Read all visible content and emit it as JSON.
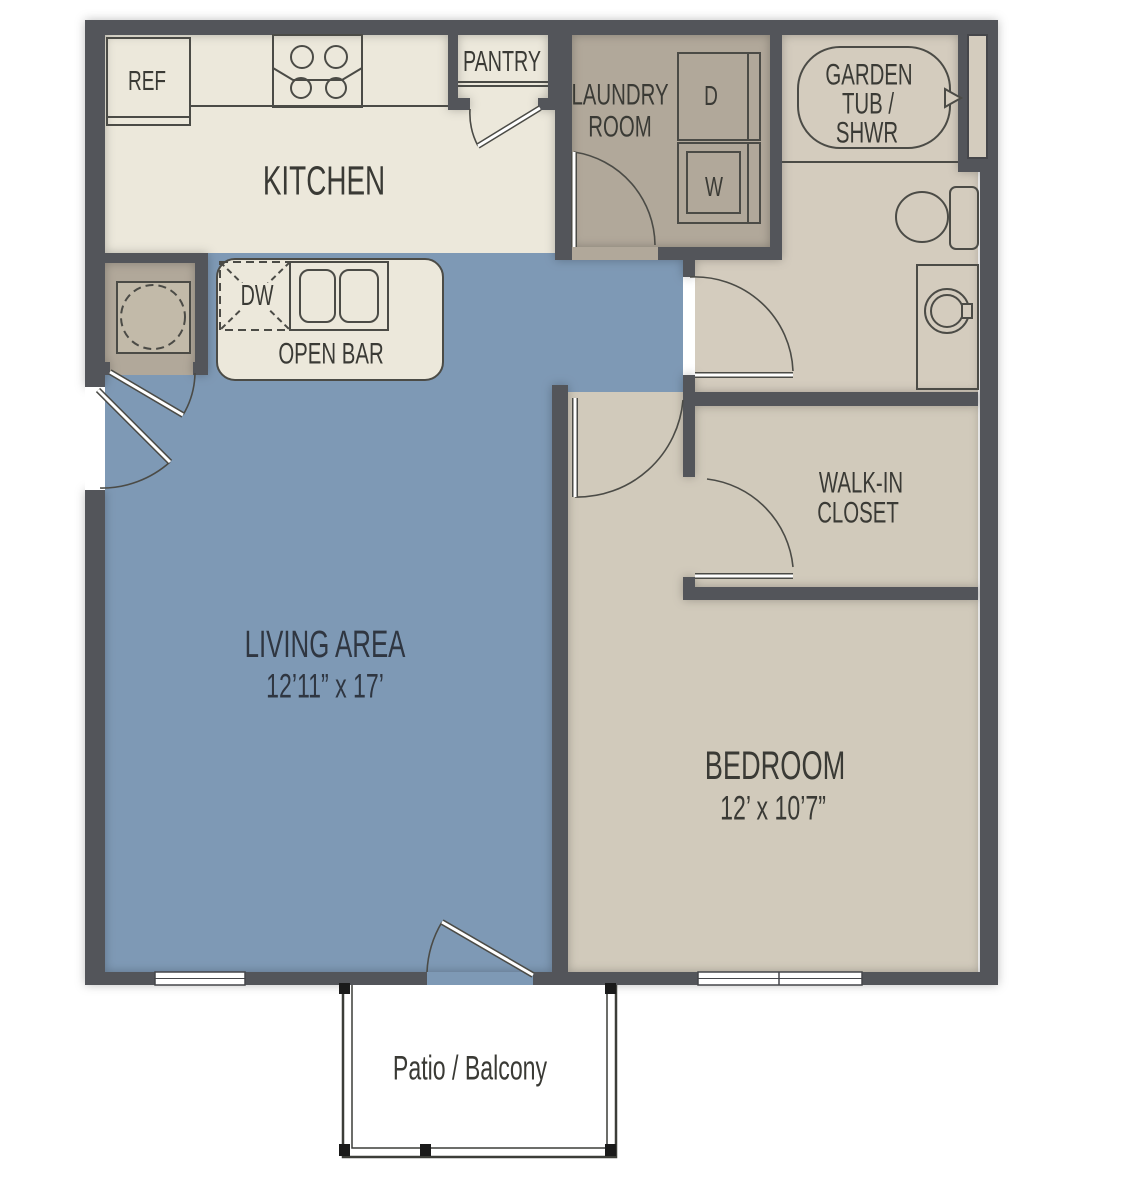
{
  "title": "One bedroom apartment floor plan",
  "colors": {
    "wall": "#53545a",
    "line": "#4b4b46",
    "kitchen_floor": "#ece8db",
    "living_floor": "#7e99b5",
    "laundry_floor": "#b1a89a",
    "bath_floor": "#d4ccbe",
    "bedroom_floor": "#d1cabb",
    "water_heater_box": "#c2baa9",
    "patio_floor": "#ffffff",
    "text_dark": "#3a3a35",
    "text_blue_area": "#2f3641"
  },
  "rooms": {
    "kitchen": {
      "label": "KITCHEN"
    },
    "pantry": {
      "label": "PANTRY"
    },
    "laundry": {
      "label_line1": "LAUNDRY",
      "label_line2": "ROOM"
    },
    "bathroom": {
      "tub_line1": "GARDEN",
      "tub_line2": "TUB /",
      "tub_line3": "SHWR"
    },
    "living": {
      "label": "LIVING AREA",
      "dimensions": "12’11” x 17’"
    },
    "bedroom": {
      "label": "BEDROOM",
      "dimensions": "12’ x 10’7”"
    },
    "closet": {
      "label_line1": "WALK-IN",
      "label_line2": "CLOSET"
    },
    "open_bar": {
      "label": "OPEN BAR"
    },
    "patio": {
      "label": "Patio / Balcony"
    }
  },
  "appliances": {
    "refrigerator": "REF",
    "dishwasher": "DW",
    "dryer": "D",
    "washer": "W"
  }
}
